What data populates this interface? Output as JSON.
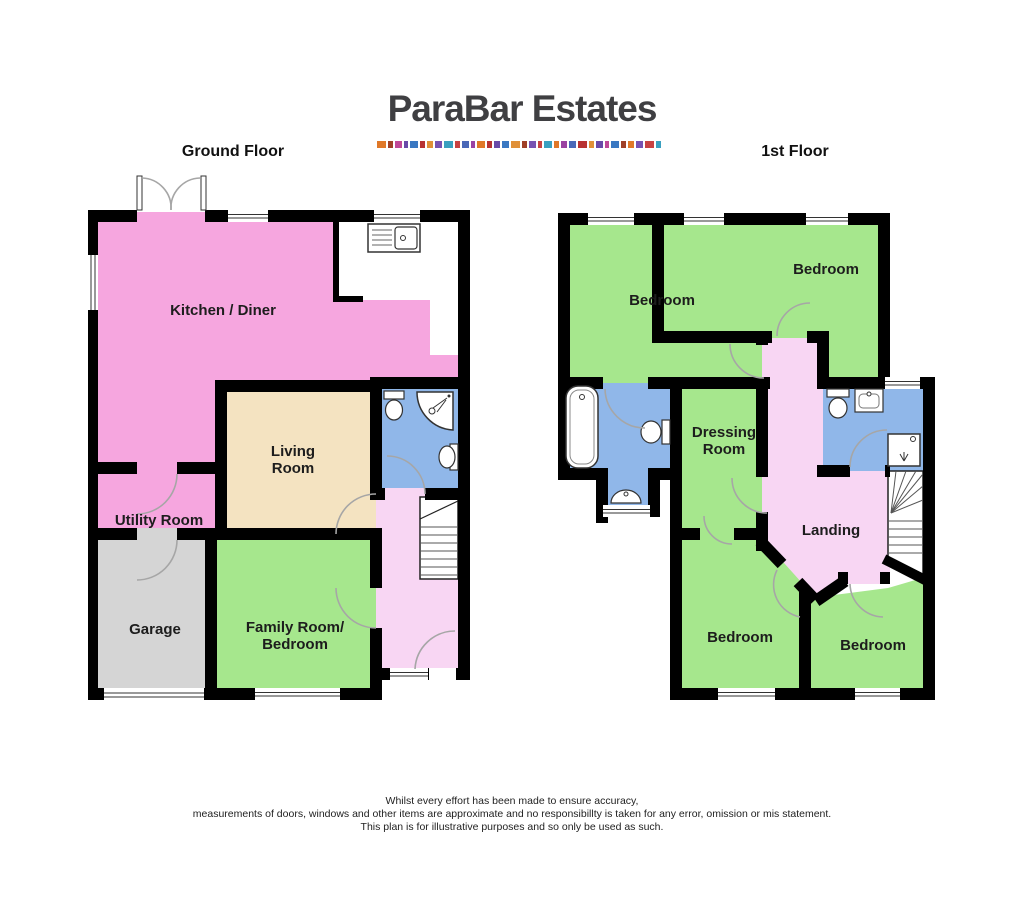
{
  "logo": {
    "title": "ParaBar Estates",
    "dash_colors": [
      "#E07828",
      "#A04028",
      "#C04898",
      "#6A4AA8",
      "#3A78C2",
      "#B83232",
      "#E09038",
      "#7852B2",
      "#3AA0C0",
      "#C84242",
      "#4A68B8",
      "#9A42A2",
      "#E07828",
      "#B83232",
      "#6A4AA8",
      "#3A78C2",
      "#E09038",
      "#A04028",
      "#7852B2",
      "#C84242",
      "#3AA0C0",
      "#E07828",
      "#9A42A2",
      "#4A68B8",
      "#B83232",
      "#E09038",
      "#6A4AA8",
      "#C04898",
      "#3A78C2",
      "#A04028",
      "#E07828",
      "#7852B2",
      "#C84242",
      "#3AA0C0"
    ]
  },
  "headers": {
    "ground": "Ground Floor",
    "first": "1st Floor"
  },
  "rooms": {
    "kitchen": "Kitchen / Diner",
    "living": "Living Room",
    "utility": "Utility Room",
    "garage": "Garage",
    "family": "Family Room/ Bedroom",
    "bedroom_tl": "Bedroom",
    "bedroom_tr": "Bedroom",
    "dressing": "Dressing Room",
    "landing": "Landing",
    "bedroom_bl": "Bedroom",
    "bedroom_br": "Bedroom"
  },
  "footer": {
    "line1": "Whilst every effort has been made to ensure accuracy,",
    "line2": "measurements of doors, windows and other items are approximate and no responsibillty is taken for any error, omission or mis statement.",
    "line3": "This plan is for illustrative purposes and so only be used as such."
  },
  "colors": {
    "wall": "#000000",
    "kitchen_pink": "#F6A6DF",
    "hall_pink": "#F8D6F3",
    "bedroom_green": "#A6E78D",
    "bathroom_blue": "#90B7E9",
    "living_beige": "#F4E3C1",
    "garage_grey": "#D5D5D5",
    "logo_text": "#3F3F42"
  }
}
